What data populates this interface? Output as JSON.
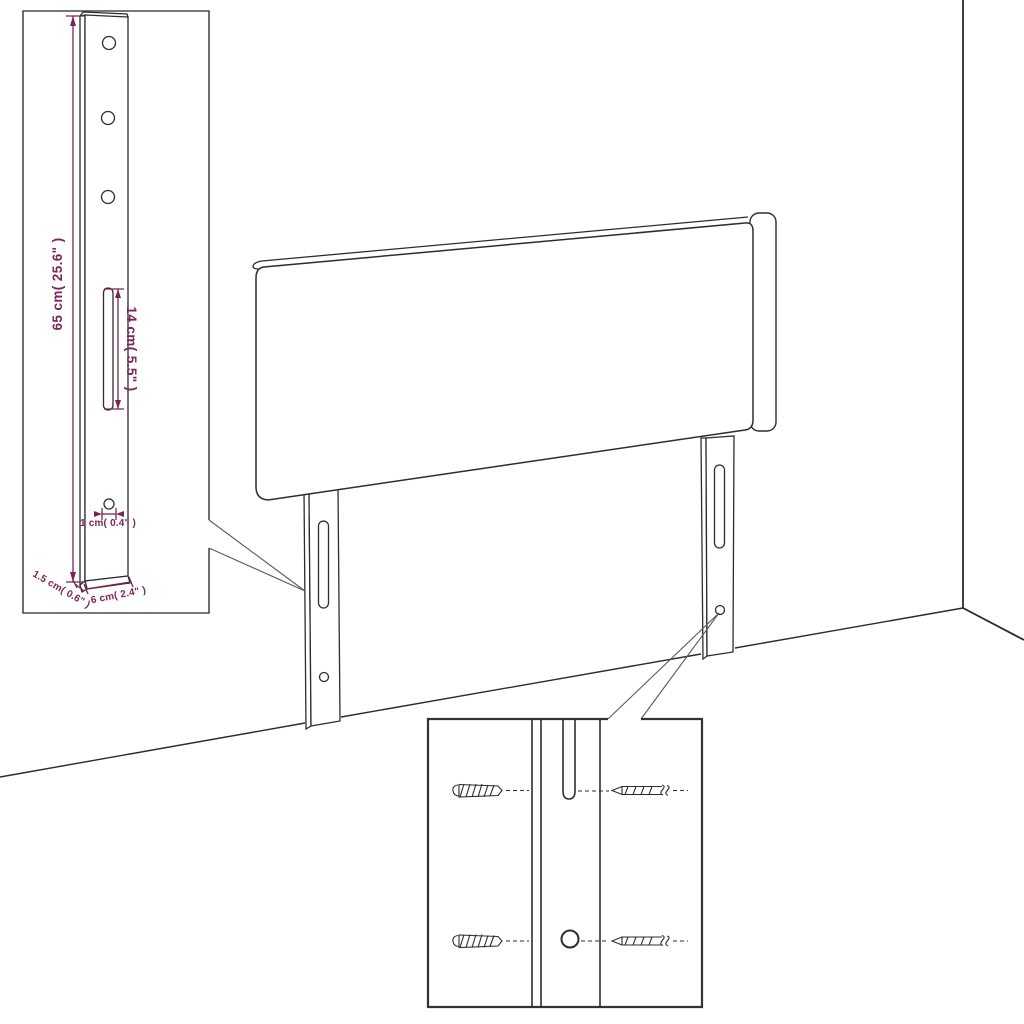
{
  "figure": {
    "title": "",
    "style": "technical line drawing",
    "colors": {
      "line_art": "#2d2d2d",
      "dimension_accent": "#7b2557",
      "background": "#ffffff"
    }
  },
  "dimensions": {
    "bracket_height": "65 cm( 25.6\" )",
    "slot_length": "14 cm( 5.5\" )",
    "hole_diameter": "1 cm( 0.4\" )",
    "bracket_thickness": "1.5 cm( 0.6\" )",
    "bracket_width": "6 cm( 2.4\" )"
  }
}
